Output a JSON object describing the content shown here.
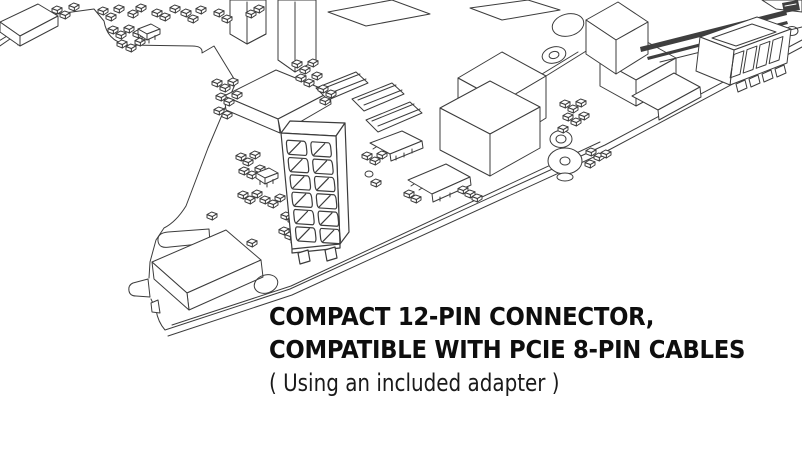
{
  "page": {
    "background": "#ffffff"
  },
  "artwork": {
    "stroke_color": "#3c3c3c",
    "depicts": "graphics-card-pcb-line-illustration",
    "highlight": "12-pin power connector"
  },
  "caption": {
    "heading_line1": "COMPACT 12-PIN CONNECTOR,",
    "heading_line2": "COMPATIBLE WITH PCIE 8-PIN CABLES",
    "subheading": "( Using an included adapter )",
    "heading_color": "#0e0e0e",
    "subheading_color": "#1a1a1a"
  }
}
